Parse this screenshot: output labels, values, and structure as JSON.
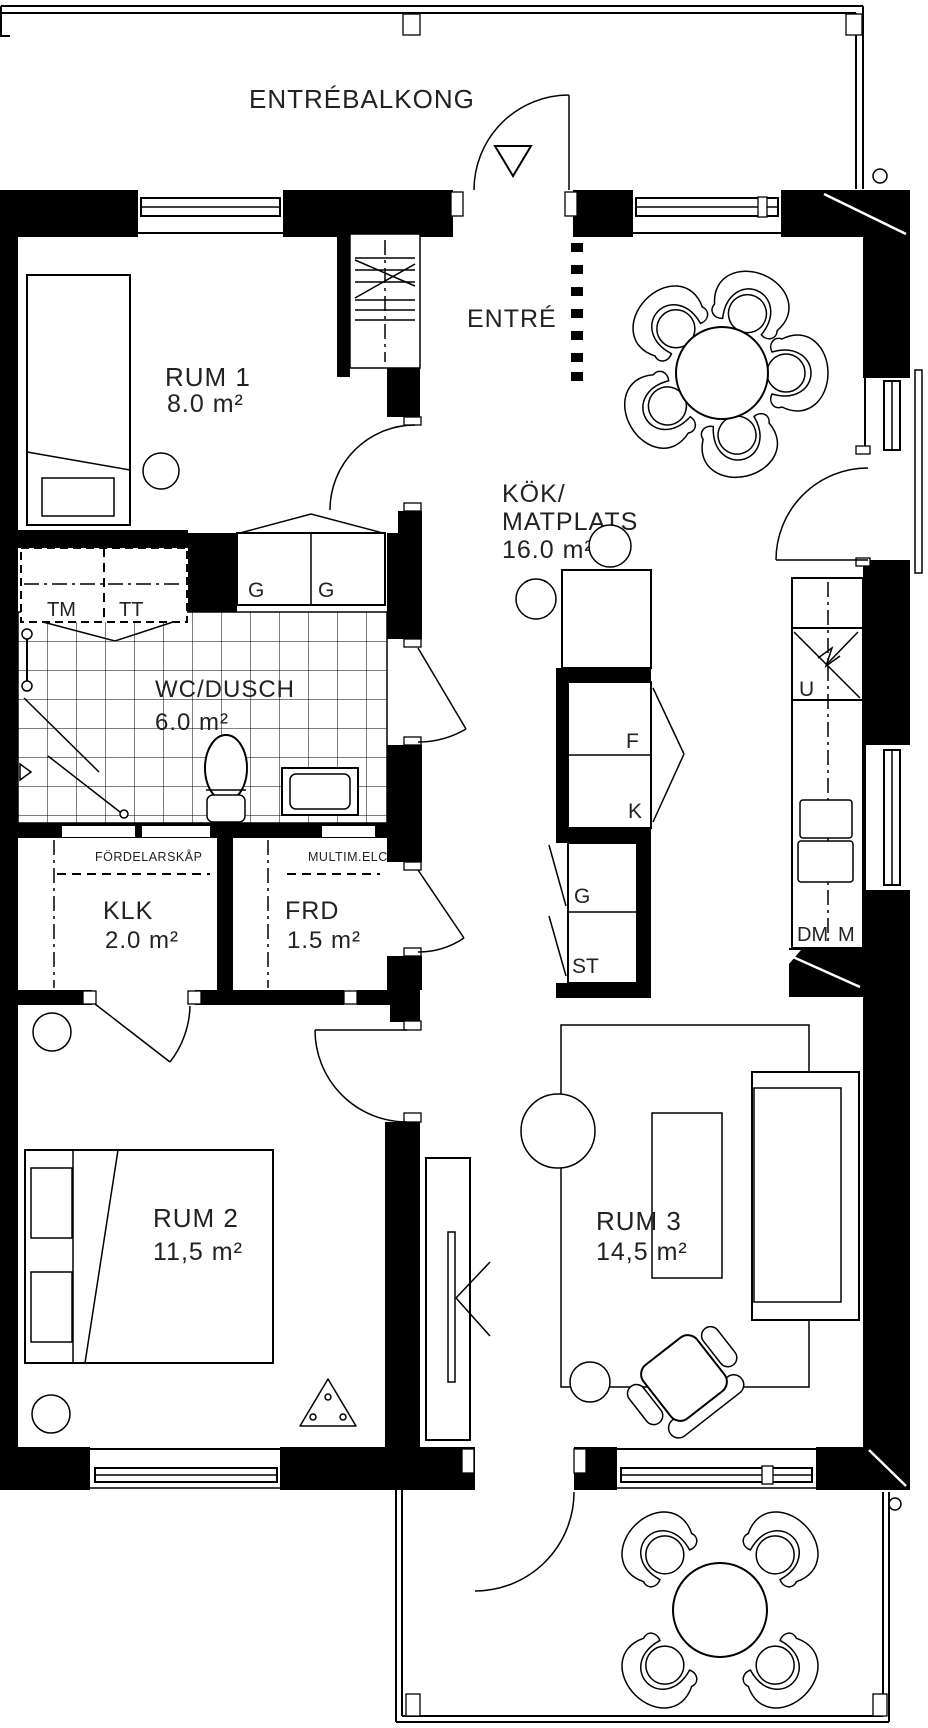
{
  "plan_title": "Apartment floor plan",
  "colors": {
    "line": "#000000",
    "background": "#ffffff",
    "text": "#222222"
  },
  "balcony_top": {
    "label": "ENTRÉBALKONG"
  },
  "balcony_bottom": {
    "label": ""
  },
  "entrance": {
    "label": "ENTRÉ"
  },
  "rooms": {
    "rum1": {
      "name": "RUM 1",
      "area": "8.0 m²"
    },
    "kitchen": {
      "line1": "KÖK/",
      "line2": "MATPLATS",
      "area": "16.0 m²"
    },
    "wc": {
      "name": "WC/DUSCH",
      "area": "6.0 m²"
    },
    "klk": {
      "name": "KLK",
      "area": "2.0 m²",
      "note": "FÖRDELARSKÅP"
    },
    "frd": {
      "name": "FRD",
      "area": "1.5 m²",
      "note": "MULTIM.ELC"
    },
    "rum2": {
      "name": "RUM 2",
      "area": "11,5 m²"
    },
    "rum3": {
      "name": "RUM 3",
      "area": "14,5 m²"
    }
  },
  "appliances": {
    "tm": "TM",
    "tt": "TT",
    "wardrobe_left": "G",
    "wardrobe_right": "G",
    "fridge": "F",
    "freezer": "K",
    "kitchen_cabinet": "G",
    "cleaning_cabinet": "ST",
    "oven": "U",
    "dishwasher": "DM",
    "micro": "M"
  }
}
